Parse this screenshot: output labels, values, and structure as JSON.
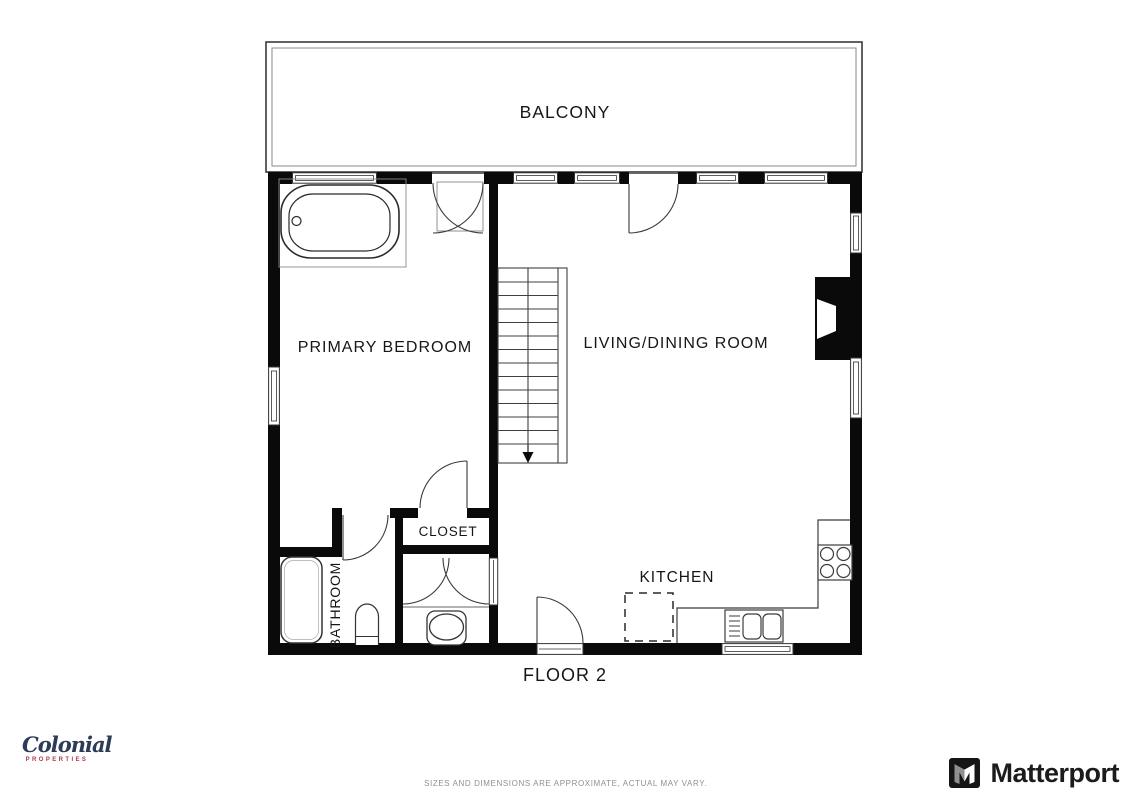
{
  "plan": {
    "floor_label": "FLOOR 2",
    "labels": {
      "balcony": "BALCONY",
      "primary_bedroom": "PRIMARY BEDROOM",
      "living_dining": "LIVING/DINING ROOM",
      "closet": "CLOSET",
      "bathroom": "BATHROOM",
      "kitchen": "KITCHEN"
    }
  },
  "footer": {
    "brand_name": "Colonial",
    "brand_subtitle": "PROPERTIES",
    "matterport_label": "Matterport",
    "disclaimer": "SIZES AND DIMENSIONS ARE APPROXIMATE, ACTUAL MAY VARY."
  },
  "colors": {
    "wall_black": "#0a0a0a",
    "line_gray": "#3c3c3c",
    "brand_navy": "#2c3b56",
    "brand_red": "#a93c4e",
    "matterport_text": "#1c1c1c",
    "disclaimer_gray": "#8f8f8f"
  }
}
